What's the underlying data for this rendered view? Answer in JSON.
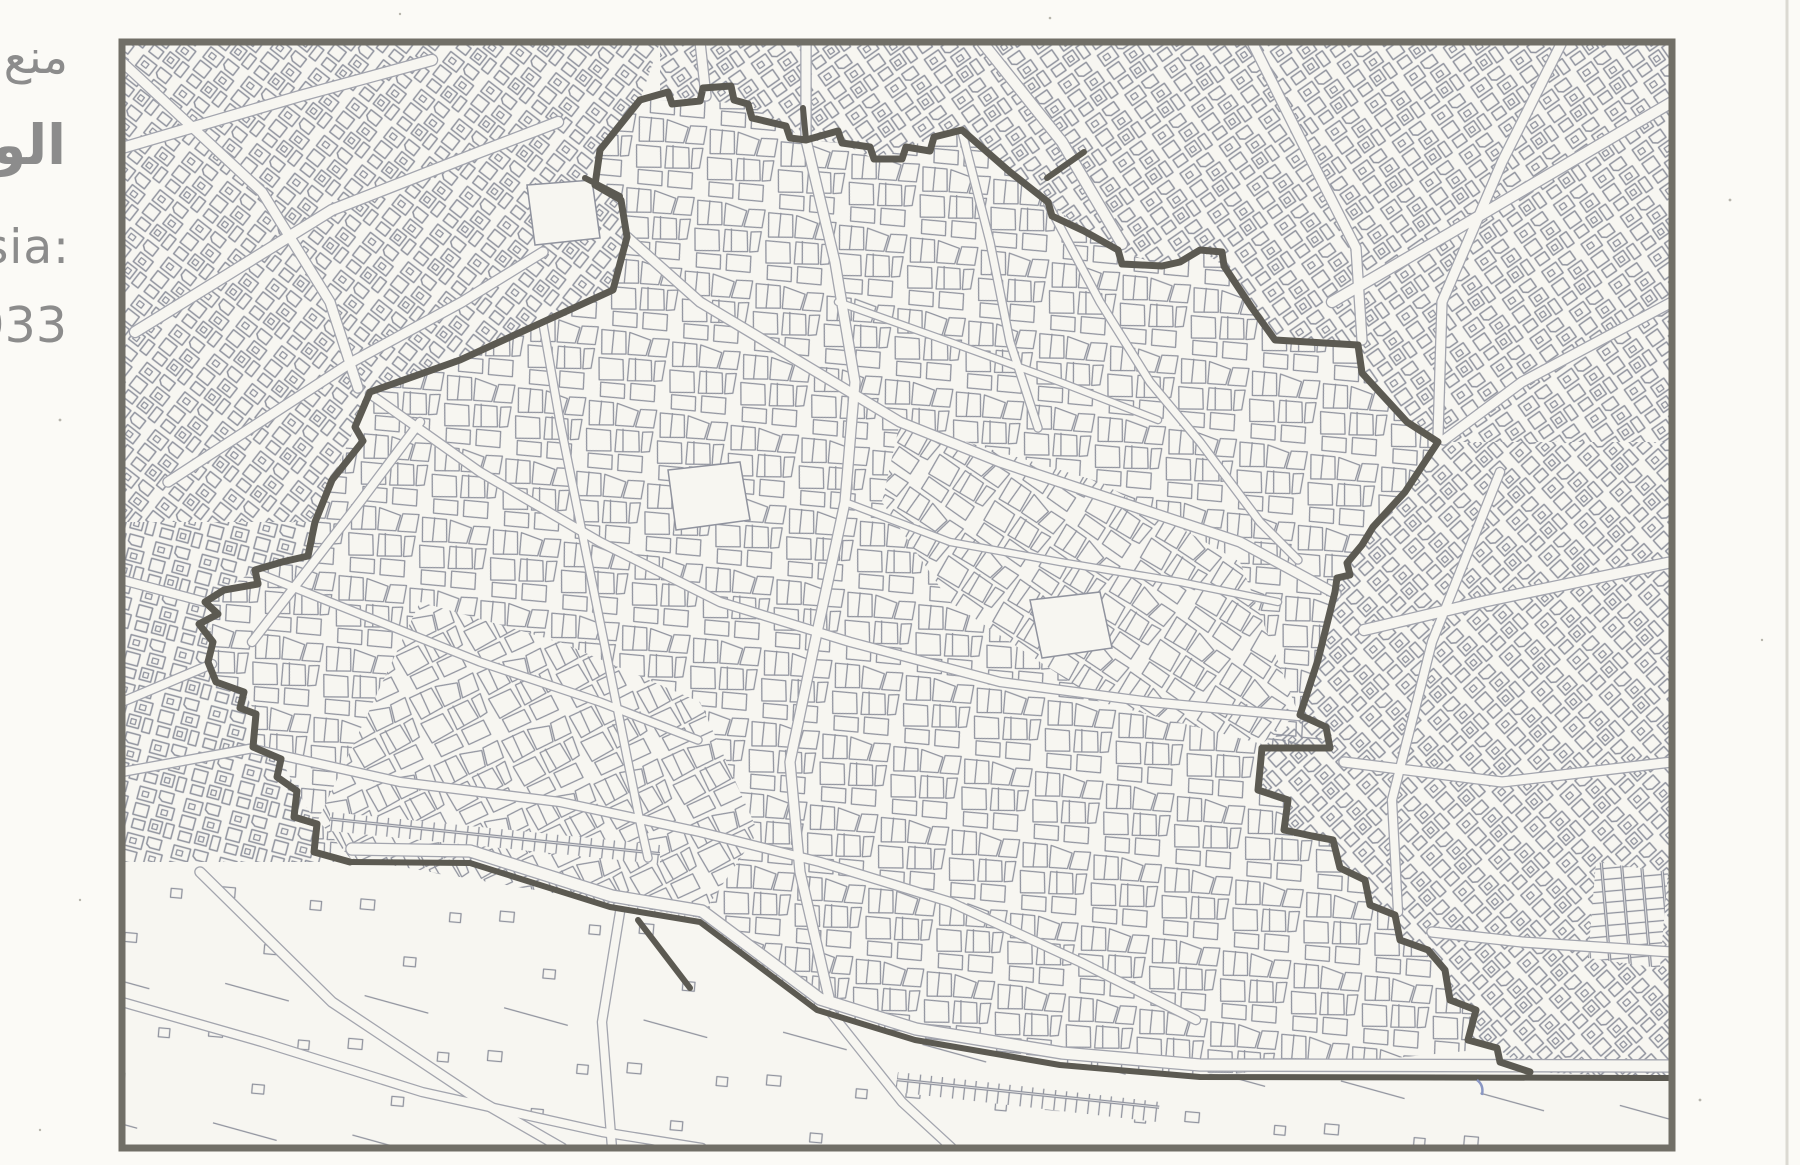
{
  "caption": {
    "line1_arabic": "منع",
    "line2_arabic": "الوص",
    "line3_latin": "sia:",
    "line4_latin": "933"
  },
  "colors": {
    "paper": "#fbfaf6",
    "map_background": "#f7f6f1",
    "parcel_line": "#90939e",
    "road_casing": "#a3a5ae",
    "rampart": "#5c5a52",
    "frame": "#716f67",
    "caption_text": "#8c8c8c",
    "pen_mark": "#8a97c4",
    "slide_edge": "#dbd9d2"
  },
  "map": {
    "frame": {
      "x": 122,
      "y": 42,
      "w": 1550,
      "h": 1106,
      "stroke_w": 7
    },
    "wall_paths": [
      {
        "name": "north-and-east-rampart",
        "w": 7,
        "points": [
          [
            640,
            100
          ],
          [
            668,
            92
          ],
          [
            672,
            104
          ],
          [
            700,
            101
          ],
          [
            703,
            88
          ],
          [
            731,
            86
          ],
          [
            734,
            100
          ],
          [
            748,
            104
          ],
          [
            752,
            118
          ],
          [
            786,
            126
          ],
          [
            790,
            138
          ],
          [
            806,
            140
          ],
          [
            838,
            131
          ],
          [
            842,
            143
          ],
          [
            870,
            147
          ],
          [
            874,
            159
          ],
          [
            902,
            159
          ],
          [
            906,
            147
          ],
          [
            930,
            151
          ],
          [
            934,
            137
          ],
          [
            962,
            130
          ],
          [
            1010,
            172
          ],
          [
            1048,
            202
          ],
          [
            1052,
            216
          ],
          [
            1084,
            231
          ],
          [
            1118,
            250
          ],
          [
            1122,
            264
          ],
          [
            1162,
            266
          ],
          [
            1180,
            262
          ],
          [
            1200,
            250
          ],
          [
            1222,
            252
          ],
          [
            1224,
            266
          ],
          [
            1252,
            308
          ],
          [
            1275,
            340
          ],
          [
            1358,
            345
          ],
          [
            1362,
            373
          ],
          [
            1407,
            422
          ],
          [
            1438,
            442
          ],
          [
            1405,
            492
          ],
          [
            1373,
            527
          ],
          [
            1362,
            545
          ],
          [
            1347,
            563
          ],
          [
            1350,
            575
          ],
          [
            1337,
            578
          ],
          [
            1335,
            592
          ],
          [
            1318,
            660
          ],
          [
            1300,
            715
          ],
          [
            1326,
            727
          ],
          [
            1330,
            748
          ],
          [
            1262,
            748
          ],
          [
            1258,
            790
          ],
          [
            1288,
            800
          ],
          [
            1284,
            830
          ],
          [
            1312,
            836
          ],
          [
            1333,
            840
          ],
          [
            1340,
            868
          ],
          [
            1365,
            880
          ],
          [
            1370,
            905
          ],
          [
            1395,
            915
          ],
          [
            1400,
            940
          ],
          [
            1428,
            950
          ],
          [
            1445,
            970
          ],
          [
            1450,
            1000
          ],
          [
            1476,
            1010
          ],
          [
            1468,
            1040
          ],
          [
            1497,
            1048
          ],
          [
            1500,
            1062
          ],
          [
            1530,
            1072
          ]
        ]
      },
      {
        "name": "west-rampart",
        "w": 7,
        "points": [
          [
            640,
            100
          ],
          [
            600,
            150
          ],
          [
            595,
            185
          ],
          [
            621,
            200
          ],
          [
            627,
            237
          ],
          [
            613,
            290
          ],
          [
            543,
            322
          ],
          [
            460,
            360
          ],
          [
            370,
            392
          ],
          [
            355,
            427
          ],
          [
            363,
            441
          ],
          [
            332,
            480
          ],
          [
            315,
            522
          ],
          [
            308,
            556
          ],
          [
            282,
            562
          ],
          [
            255,
            570
          ],
          [
            258,
            584
          ],
          [
            224,
            590
          ],
          [
            205,
            602
          ],
          [
            218,
            614
          ],
          [
            199,
            624
          ],
          [
            213,
            642
          ],
          [
            208,
            662
          ],
          [
            216,
            682
          ],
          [
            244,
            692
          ],
          [
            240,
            708
          ],
          [
            256,
            714
          ],
          [
            253,
            747
          ],
          [
            281,
            759
          ],
          [
            277,
            777
          ],
          [
            297,
            791
          ],
          [
            294,
            817
          ],
          [
            317,
            824
          ],
          [
            314,
            852
          ],
          [
            350,
            862
          ]
        ]
      },
      {
        "name": "south-boundary-road-edge",
        "w": 6,
        "points": [
          [
            350,
            862
          ],
          [
            470,
            863
          ],
          [
            610,
            907
          ],
          [
            700,
            922
          ],
          [
            817,
            1010
          ],
          [
            915,
            1040
          ],
          [
            1060,
            1065
          ],
          [
            1200,
            1077
          ],
          [
            1672,
            1078
          ]
        ]
      },
      {
        "name": "gate-stub-northwest",
        "w": 6,
        "points": [
          [
            585,
            178
          ],
          [
            620,
            196
          ]
        ]
      },
      {
        "name": "gate-stub-north",
        "w": 6,
        "points": [
          [
            803,
            108
          ],
          [
            806,
            140
          ]
        ]
      },
      {
        "name": "gate-stub-northeast-cross",
        "w": 6,
        "points": [
          [
            1047,
            178
          ],
          [
            1084,
            152
          ]
        ]
      },
      {
        "name": "south-spur",
        "w": 6,
        "points": [
          [
            638,
            920
          ],
          [
            690,
            988
          ]
        ]
      }
    ],
    "roads": [
      {
        "name": "nw-radial-1",
        "w": 10,
        "points": [
          [
            122,
            148
          ],
          [
            300,
            96
          ],
          [
            432,
            60
          ]
        ]
      },
      {
        "name": "nw-radial-2",
        "w": 10,
        "points": [
          [
            135,
            332
          ],
          [
            332,
            210
          ],
          [
            480,
            152
          ],
          [
            558,
            122
          ]
        ]
      },
      {
        "name": "nw-radial-3",
        "w": 9,
        "points": [
          [
            168,
            482
          ],
          [
            352,
            362
          ],
          [
            462,
            302
          ],
          [
            543,
            252
          ]
        ]
      },
      {
        "name": "nw-cross",
        "w": 9,
        "points": [
          [
            122,
            62
          ],
          [
            262,
            192
          ],
          [
            330,
            302
          ],
          [
            358,
            388
          ]
        ]
      },
      {
        "name": "w-radial",
        "w": 8,
        "points": [
          [
            252,
            642
          ],
          [
            360,
            502
          ],
          [
            420,
            422
          ]
        ]
      },
      {
        "name": "w-stub-1",
        "w": 8,
        "points": [
          [
            122,
            580
          ],
          [
            205,
            602
          ]
        ]
      },
      {
        "name": "w-stub-2",
        "w": 8,
        "points": [
          [
            122,
            702
          ],
          [
            212,
            664
          ]
        ]
      },
      {
        "name": "w-stub-3",
        "w": 8,
        "points": [
          [
            122,
            772
          ],
          [
            254,
            748
          ]
        ]
      },
      {
        "name": "ne-radial-1",
        "w": 10,
        "points": [
          [
            982,
            42
          ],
          [
            1062,
            142
          ],
          [
            1122,
            244
          ]
        ]
      },
      {
        "name": "ne-radial-2",
        "w": 9,
        "points": [
          [
            1252,
            42
          ],
          [
            1302,
            142
          ],
          [
            1356,
            248
          ],
          [
            1362,
            340
          ]
        ]
      },
      {
        "name": "ne-cross-1",
        "w": 10,
        "points": [
          [
            1672,
            102
          ],
          [
            1452,
            232
          ],
          [
            1332,
            302
          ]
        ]
      },
      {
        "name": "ne-radial-3",
        "w": 9,
        "points": [
          [
            1562,
            42
          ],
          [
            1502,
            162
          ],
          [
            1442,
            302
          ],
          [
            1438,
            436
          ]
        ]
      },
      {
        "name": "ne-cross-2",
        "w": 9,
        "points": [
          [
            1672,
            302
          ],
          [
            1522,
            382
          ],
          [
            1444,
            440
          ]
        ]
      },
      {
        "name": "n-gate-road-1",
        "w": 9,
        "points": [
          [
            700,
            42
          ],
          [
            706,
            96
          ]
        ]
      },
      {
        "name": "n-gate-road-2",
        "w": 9,
        "points": [
          [
            806,
            42
          ],
          [
            806,
            136
          ]
        ]
      },
      {
        "name": "e-cross-1",
        "w": 10,
        "points": [
          [
            1672,
            562
          ],
          [
            1482,
            602
          ],
          [
            1364,
            630
          ]
        ]
      },
      {
        "name": "e-cross-2",
        "w": 9,
        "points": [
          [
            1672,
            762
          ],
          [
            1502,
            782
          ],
          [
            1344,
            762
          ]
        ]
      },
      {
        "name": "e-cross-3",
        "w": 9,
        "points": [
          [
            1672,
            952
          ],
          [
            1522,
            942
          ],
          [
            1432,
            932
          ]
        ]
      },
      {
        "name": "e-parallel",
        "w": 8,
        "points": [
          [
            1500,
            472
          ],
          [
            1432,
            642
          ],
          [
            1392,
            800
          ],
          [
            1398,
            912
          ]
        ]
      },
      {
        "name": "s-lane-1",
        "w": 9,
        "points": [
          [
            200,
            872
          ],
          [
            332,
            1002
          ],
          [
            482,
            1102
          ],
          [
            562,
            1148
          ]
        ]
      },
      {
        "name": "s-lane-2",
        "w": 8,
        "points": [
          [
            620,
            912
          ],
          [
            602,
            1022
          ],
          [
            612,
            1148
          ]
        ]
      },
      {
        "name": "s-lane-3",
        "w": 8,
        "points": [
          [
            832,
            1014
          ],
          [
            902,
            1102
          ],
          [
            952,
            1148
          ]
        ]
      },
      {
        "name": "s-lane-4",
        "w": 8,
        "points": [
          [
            122,
            1002
          ],
          [
            262,
            1042
          ],
          [
            422,
            1092
          ],
          [
            602,
            1132
          ],
          [
            702,
            1148
          ]
        ]
      },
      {
        "name": "s-boundary-inner-road",
        "w": 11,
        "points": [
          [
            352,
            849
          ],
          [
            470,
            851
          ],
          [
            612,
            896
          ],
          [
            702,
            911
          ],
          [
            820,
            999
          ],
          [
            916,
            1029
          ],
          [
            1062,
            1053
          ],
          [
            1200,
            1065
          ],
          [
            1672,
            1066
          ]
        ]
      },
      {
        "name": "medina-north-south-main",
        "w": 9,
        "points": [
          [
            806,
            140
          ],
          [
            835,
            262
          ],
          [
            855,
            382
          ],
          [
            845,
            502
          ],
          [
            815,
            642
          ],
          [
            790,
            762
          ],
          [
            800,
            872
          ],
          [
            830,
            1002
          ]
        ]
      },
      {
        "name": "medina-diagonal-main",
        "w": 9,
        "points": [
          [
            627,
            237
          ],
          [
            700,
            302
          ],
          [
            800,
            362
          ],
          [
            900,
            422
          ],
          [
            1000,
            462
          ],
          [
            1120,
            502
          ],
          [
            1240,
            542
          ],
          [
            1336,
            594
          ]
        ]
      },
      {
        "name": "medina-street-1",
        "w": 7,
        "points": [
          [
            962,
            132
          ],
          [
            990,
            242
          ],
          [
            1010,
            342
          ],
          [
            1038,
            428
          ]
        ]
      },
      {
        "name": "medina-cross-main",
        "w": 8,
        "points": [
          [
            370,
            394
          ],
          [
            480,
            472
          ],
          [
            600,
            542
          ],
          [
            720,
            602
          ],
          [
            850,
            642
          ],
          [
            1000,
            682
          ],
          [
            1150,
            702
          ],
          [
            1298,
            716
          ]
        ]
      },
      {
        "name": "medina-street-2",
        "w": 7,
        "points": [
          [
            255,
            572
          ],
          [
            380,
            622
          ],
          [
            480,
            662
          ],
          [
            600,
            702
          ],
          [
            698,
            740
          ]
        ]
      },
      {
        "name": "medina-south-street",
        "w": 8,
        "points": [
          [
            253,
            749
          ],
          [
            400,
            782
          ],
          [
            560,
            802
          ],
          [
            700,
            832
          ],
          [
            820,
            862
          ],
          [
            950,
            902
          ],
          [
            1080,
            962
          ],
          [
            1196,
            1020
          ]
        ]
      },
      {
        "name": "medina-west-street",
        "w": 7,
        "points": [
          [
            543,
            324
          ],
          [
            560,
            422
          ],
          [
            580,
            522
          ],
          [
            600,
            622
          ],
          [
            620,
            722
          ],
          [
            640,
            822
          ],
          [
            648,
            858
          ]
        ]
      },
      {
        "name": "medina-east-street",
        "w": 7,
        "points": [
          [
            1048,
            204
          ],
          [
            1100,
            302
          ],
          [
            1150,
            382
          ],
          [
            1200,
            442
          ],
          [
            1260,
            522
          ],
          [
            1298,
            560
          ]
        ]
      },
      {
        "name": "medina-lane-1",
        "w": 6,
        "points": [
          [
            845,
            502
          ],
          [
            950,
            542
          ],
          [
            1060,
            562
          ],
          [
            1180,
            582
          ],
          [
            1278,
            602
          ]
        ]
      },
      {
        "name": "medina-lane-2",
        "w": 6,
        "points": [
          [
            838,
            302
          ],
          [
            950,
            342
          ],
          [
            1060,
            382
          ],
          [
            1158,
            420
          ]
        ]
      }
    ]
  }
}
